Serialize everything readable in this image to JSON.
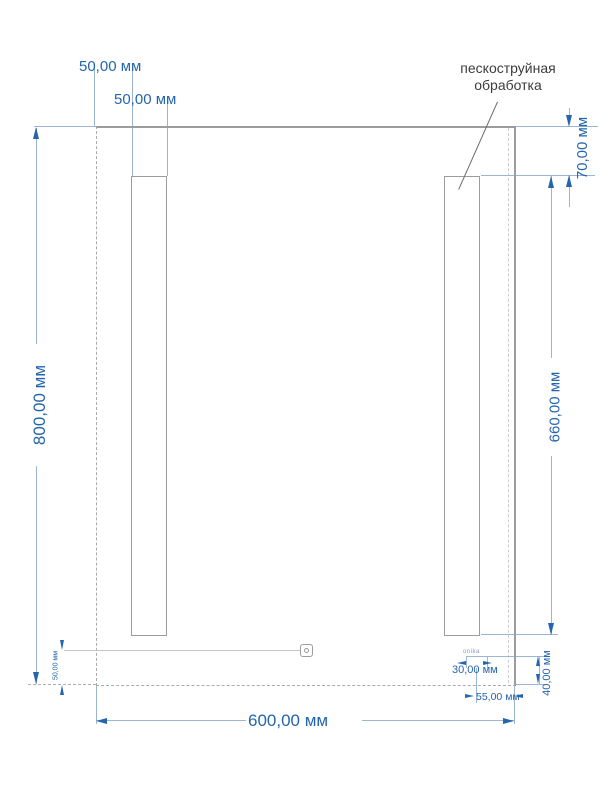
{
  "drawing": {
    "labels": {
      "sandblast_line1": "пескоструйная",
      "sandblast_line2": "обработка",
      "logo": "onika"
    },
    "dimensions": {
      "strip_offset_left": "50,00 мм",
      "strip_width": "50,00 мм",
      "mirror_height": "800,00 мм",
      "mirror_width": "600,00 мм",
      "strip_offset_top": "70,00 мм",
      "strip_height": "660,00 мм",
      "logo_width": "30,00 мм",
      "logo_height": "40,00 мм",
      "logo_offset_right": "55,00 мм",
      "switch_offset_bottom": "50,00 мм"
    },
    "colors": {
      "dimension_text": "#2565ae",
      "extension_line": "#9bb5d4",
      "outline": "#9c9c9c",
      "annotation_text": "#3c3c3c"
    }
  }
}
